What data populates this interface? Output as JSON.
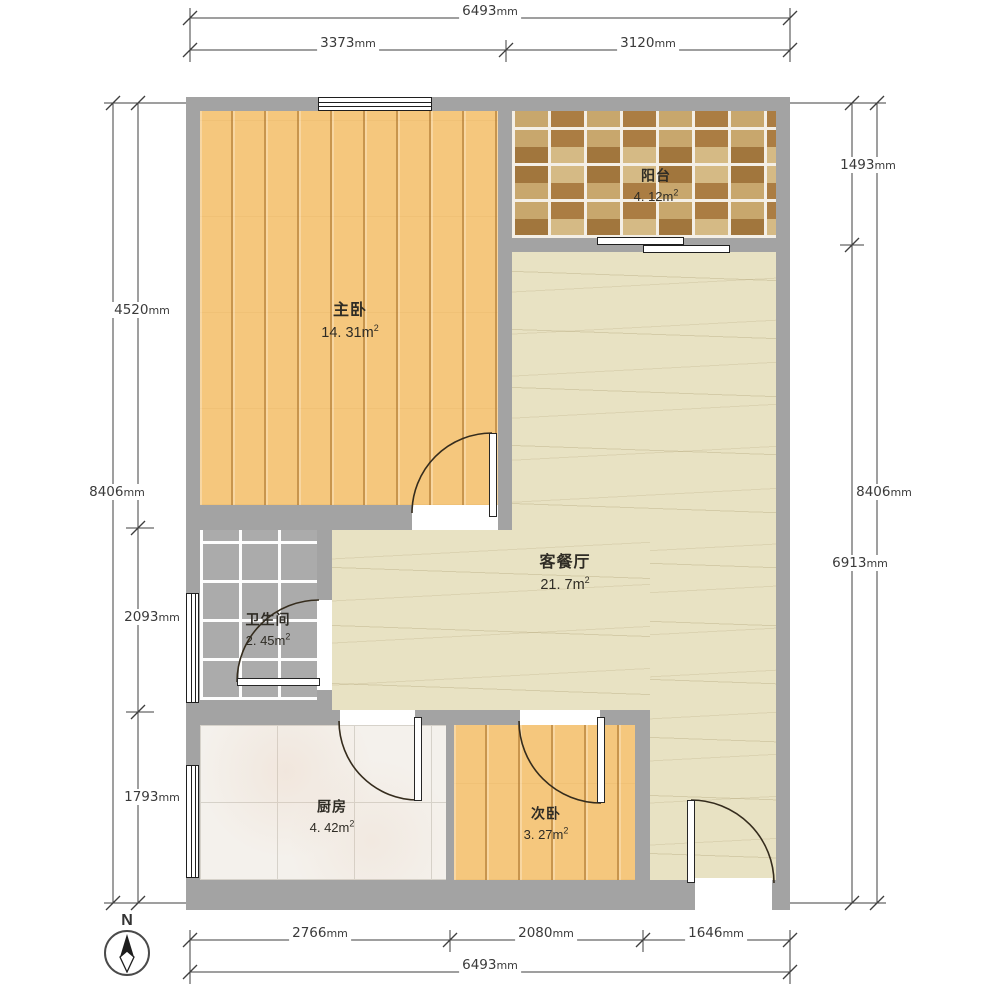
{
  "plan_title": "apartment floor plan",
  "compass": {
    "north_label": "N"
  },
  "rooms": [
    {
      "id": "master-bedroom",
      "name": "主卧",
      "area": "14. 31",
      "unit": "m",
      "unit_sup": "2"
    },
    {
      "id": "balcony",
      "name": "阳台",
      "area": "4. 12",
      "unit": "m",
      "unit_sup": "2"
    },
    {
      "id": "living-dining",
      "name": "客餐厅",
      "area": "21. 7",
      "unit": "m",
      "unit_sup": "2"
    },
    {
      "id": "bathroom",
      "name": "卫生间",
      "area": "2. 45",
      "unit": "m",
      "unit_sup": "2"
    },
    {
      "id": "kitchen",
      "name": "厨房",
      "area": "4. 42",
      "unit": "m",
      "unit_sup": "2"
    },
    {
      "id": "second-bedroom",
      "name": "次卧",
      "area": "3. 27",
      "unit": "m",
      "unit_sup": "2"
    }
  ],
  "dimensions": {
    "top": [
      {
        "value": "6493",
        "unit": "mm"
      },
      {
        "value": "3373",
        "unit": "mm"
      },
      {
        "value": "3120",
        "unit": "mm"
      }
    ],
    "bottom": [
      {
        "value": "2766",
        "unit": "mm"
      },
      {
        "value": "2080",
        "unit": "mm"
      },
      {
        "value": "1646",
        "unit": "mm"
      },
      {
        "value": "6493",
        "unit": "mm"
      }
    ],
    "left": [
      {
        "value": "8406",
        "unit": "mm"
      },
      {
        "value": "4520",
        "unit": "mm"
      },
      {
        "value": "2093",
        "unit": "mm"
      },
      {
        "value": "1793",
        "unit": "mm"
      }
    ],
    "right": [
      {
        "value": "1493",
        "unit": "mm"
      },
      {
        "value": "8406",
        "unit": "mm"
      },
      {
        "value": "6913",
        "unit": "mm"
      }
    ]
  },
  "palette": {
    "wall": "#a3a3a3",
    "wood_floor": "#f5c77d",
    "balcony_tile_dark": "#ab7d43",
    "balcony_tile_light": "#d5ba85",
    "living_floor": "#e8e2c3",
    "bathroom_tile": "#ababab",
    "kitchen_tile": "#f4f1ec",
    "dimension_text": "#3a3a3a"
  }
}
